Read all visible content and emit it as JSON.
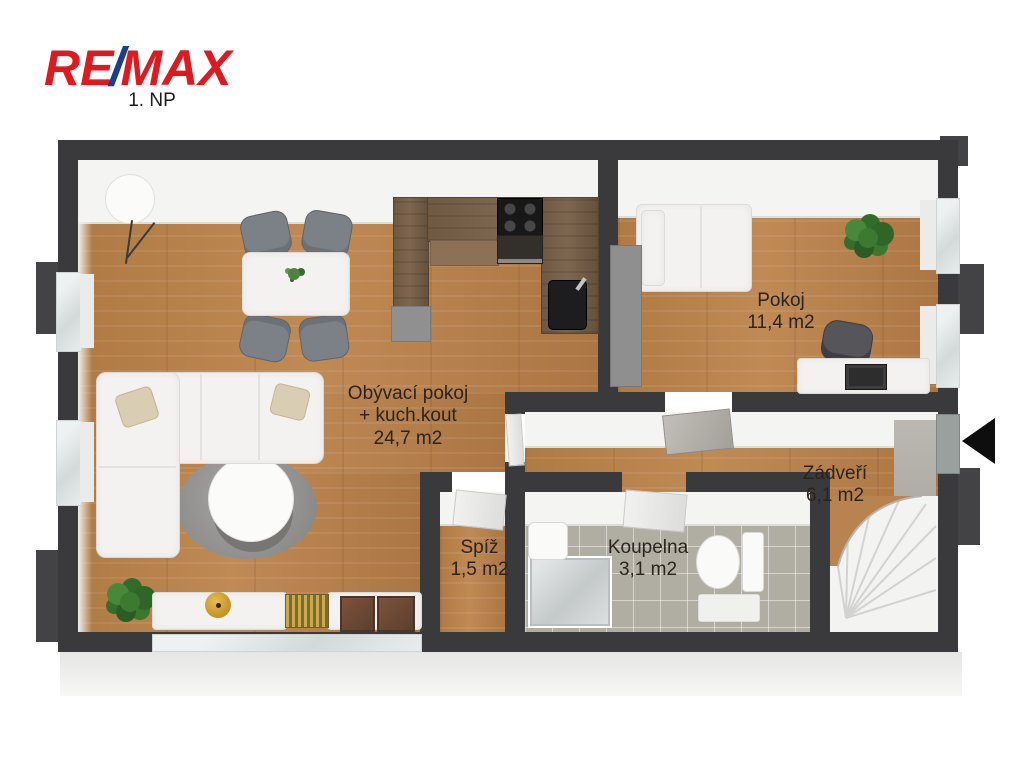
{
  "logo": {
    "re": "RE",
    "slash": "/",
    "max": "MAX"
  },
  "floor_label": "1. NP",
  "rooms": {
    "living": {
      "name_line1": "Obývací pokoj",
      "name_line2": "+ kuch.kout",
      "area": "24,7 m2"
    },
    "bedroom": {
      "name": "Pokoj",
      "area": "11,4 m2"
    },
    "hall": {
      "name": "Zádveří",
      "area": "6,1 m2"
    },
    "pantry": {
      "name": "Spíž",
      "area": "1,5 m2"
    },
    "bathroom": {
      "name": "Koupelna",
      "area": "3,1 m2"
    }
  },
  "colors": {
    "logo_red": "#e1191f",
    "logo_blue": "#1b3e90",
    "wall": "#3a3a3c",
    "wood_floor": "#b9834f",
    "tile_floor": "#b0aea3",
    "label_text": "#2b241c"
  },
  "icons": {
    "entrance_arrow": "left-triangle"
  }
}
